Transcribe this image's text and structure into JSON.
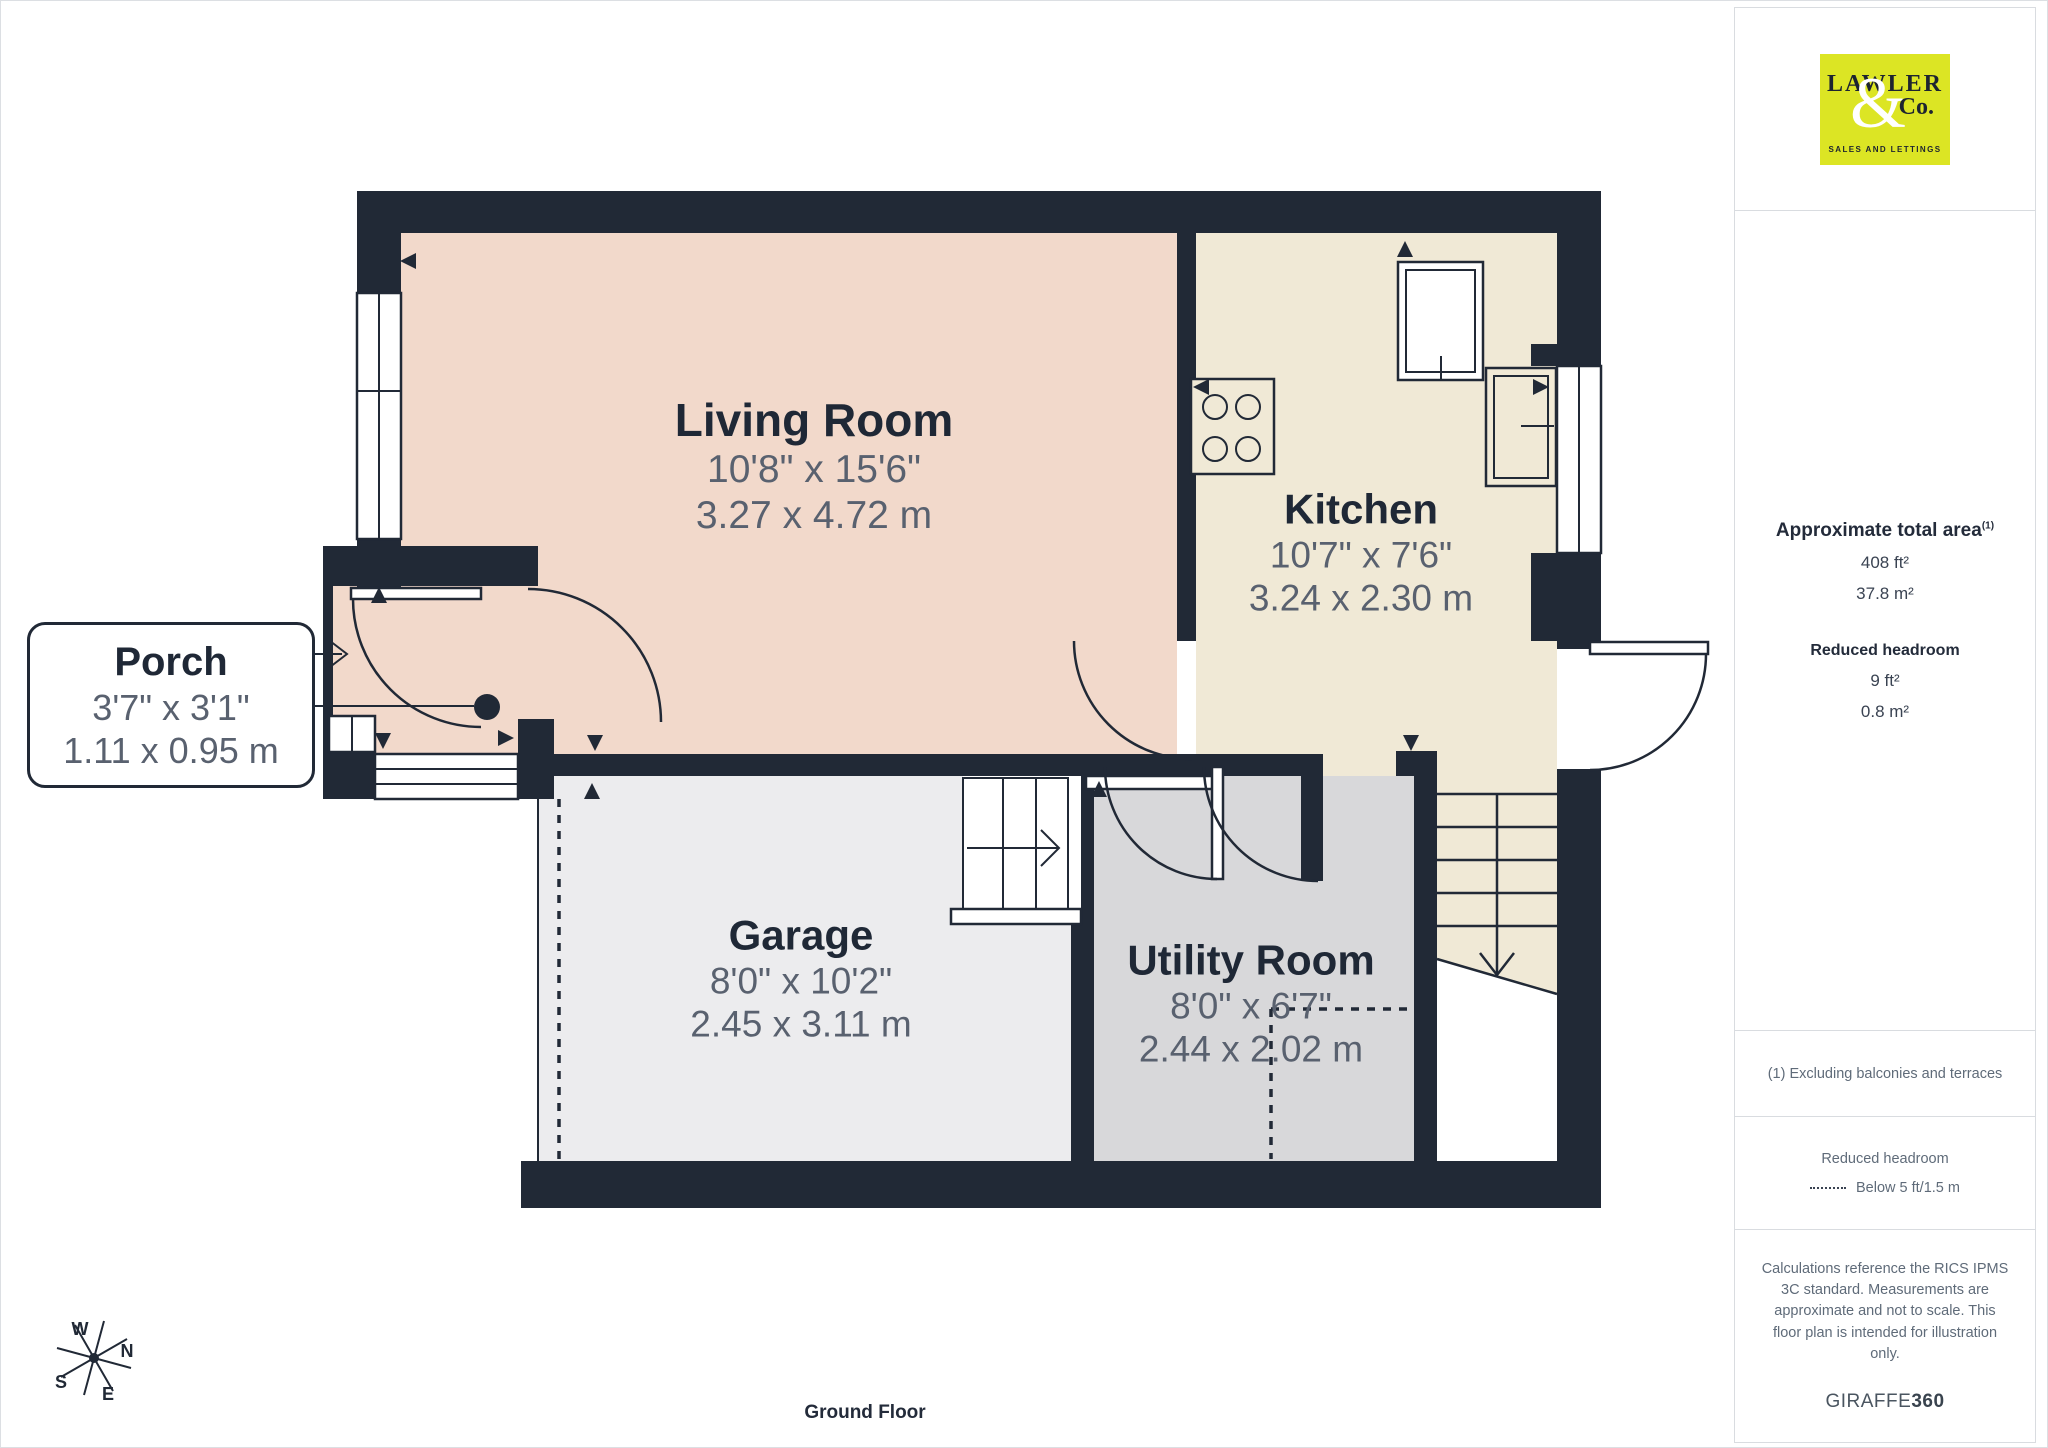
{
  "page": {
    "floor_label": "Ground Floor"
  },
  "branding": {
    "logo_name": "LAWLER",
    "logo_ampersand": "&",
    "logo_co": "Co.",
    "logo_tagline": "SALES AND LETTINGS",
    "credit_brand": "GIRAFFE",
    "credit_brand_bold": "360"
  },
  "sidebar": {
    "area_heading": "Approximate total area",
    "area_heading_sup": "(1)",
    "area_imperial": "408 ft²",
    "area_metric": "37.8 m²",
    "headroom_heading": "Reduced headroom",
    "headroom_imperial": "9 ft²",
    "headroom_metric": "0.8 m²",
    "footnote": "(1) Excluding balconies and terraces",
    "legend_heading": "Reduced headroom",
    "legend_value": "Below 5 ft/1.5 m",
    "disclaimer": "Calculations reference the RICS IPMS 3C standard. Measurements are approximate and not to scale. This floor plan is intended for illustration only."
  },
  "compass": {
    "north": "N",
    "east": "E",
    "south": "S",
    "west": "W"
  },
  "rooms": {
    "living_room": {
      "name": "Living Room",
      "imperial": "10'8\" x 15'6\"",
      "metric": "3.27 x 4.72 m"
    },
    "kitchen": {
      "name": "Kitchen",
      "imperial": "10'7\" x 7'6\"",
      "metric": "3.24 x 2.30 m"
    },
    "porch": {
      "name": "Porch",
      "imperial": "3'7\" x 3'1\"",
      "metric": "1.11 x 0.95 m"
    },
    "garage": {
      "name": "Garage",
      "imperial": "8'0\" x 10'2\"",
      "metric": "2.45 x 3.11 m"
    },
    "utility_room": {
      "name": "Utility Room",
      "imperial": "8'0\" x 6'7\"",
      "metric": "2.44 x 2.02 m"
    }
  },
  "colors": {
    "wall": "#212936",
    "living": "#f2d9cb",
    "kitchen": "#f0e9d6",
    "garage": "#ececee",
    "utility": "#d8d8da",
    "logo_bg": "#dce524",
    "accent_text": "#1f2836",
    "dim_text": "#59616f"
  }
}
